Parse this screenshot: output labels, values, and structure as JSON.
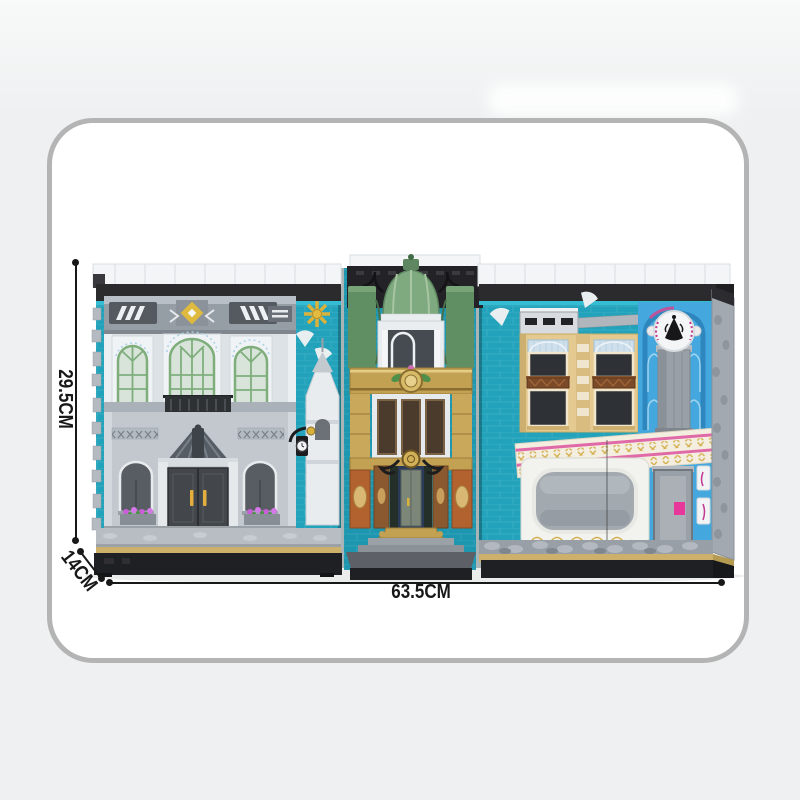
{
  "product_card": {
    "shape": "rounded-rectangle",
    "border_color": "#b4b4b4",
    "background": "#ffffff"
  },
  "dimensions": {
    "height_label": "29.5CM",
    "depth_label": "14CM",
    "width_label": "63.5CM"
  },
  "illustration": {
    "description": "Brick-built modular street scene opened like a book: grey classical facade on the left, teal atrium with green copper dome in the center, tan and blue boutique facade on the right",
    "colors": {
      "page_background": "#eef0f1",
      "dimension_ink": "#181818",
      "teal_wall": "#23a3bb",
      "teal_wall_dark": "#1d96af",
      "roof_white": "#f3f5f7",
      "roof_black": "#2b2b2e",
      "left_facade_gray": "#cdd3d8",
      "window_green": "#7fae7c",
      "dome_green": "#7fa97e",
      "gold": "#c3a152",
      "terracotta": "#b2622f",
      "tan_facade": "#e4ca90",
      "blue_facade": "#44a8de",
      "pink_stripe": "#e06aa8",
      "cream_band": "#f3eee0",
      "stone_gray": "#a2a9b0",
      "base_black": "#1f2023",
      "base_tan": "#cdb069"
    }
  }
}
